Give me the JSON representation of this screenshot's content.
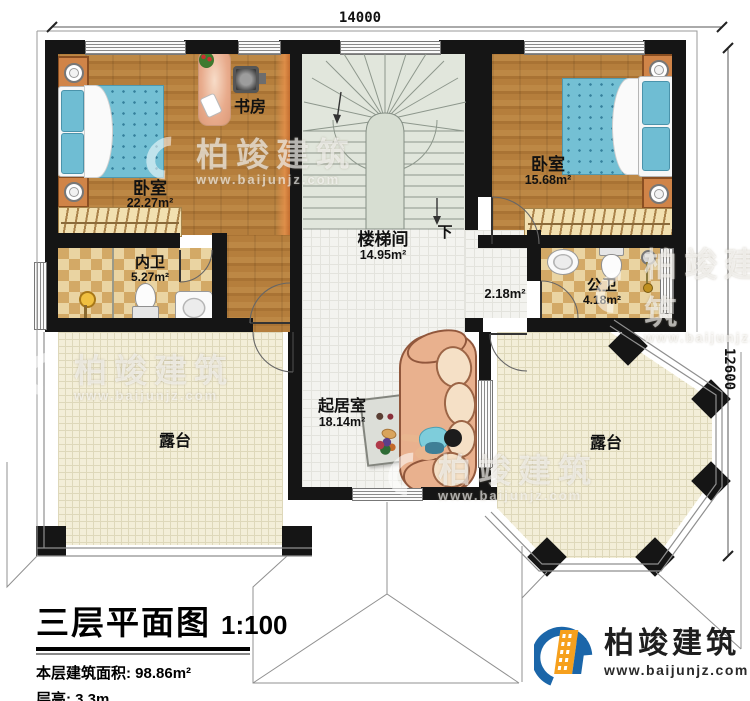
{
  "plan": {
    "dim_top": "14000",
    "dim_right": "12600",
    "rooms": {
      "bedroom_left": {
        "name": "卧室",
        "area": "22.27m²"
      },
      "study": {
        "name": "书房"
      },
      "bedroom_right": {
        "name": "卧室",
        "area": "15.68m²"
      },
      "stairwell": {
        "name": "楼梯间",
        "area": "14.95m²",
        "down_label": "下"
      },
      "ensuite_bath": {
        "name": "内卫",
        "area": "5.27m²"
      },
      "public_bath": {
        "name": "公卫",
        "area": "4.18m²"
      },
      "hallway": {
        "area": "2.18m²"
      },
      "living_room": {
        "name": "起居室",
        "area": "18.14m²"
      },
      "terrace_left": {
        "name": "露台"
      },
      "terrace_right": {
        "name": "露台"
      }
    }
  },
  "title_block": {
    "title": "三层平面图",
    "scale": "1:100",
    "area_label": "本层建筑面积:",
    "area_value": "98.86m²",
    "height_label": "层高:",
    "height_value": "3.3m"
  },
  "brand": {
    "name": "柏竣建筑",
    "website": "www.baijunjz.com"
  },
  "watermark": {
    "name": "柏竣建筑",
    "website": "www.baijunjz.com"
  },
  "colors": {
    "brand_blue": "#1b66a9",
    "brand_orange": "#f6a01d",
    "wall": "#151515",
    "bed_blue": "#74c0d4"
  }
}
